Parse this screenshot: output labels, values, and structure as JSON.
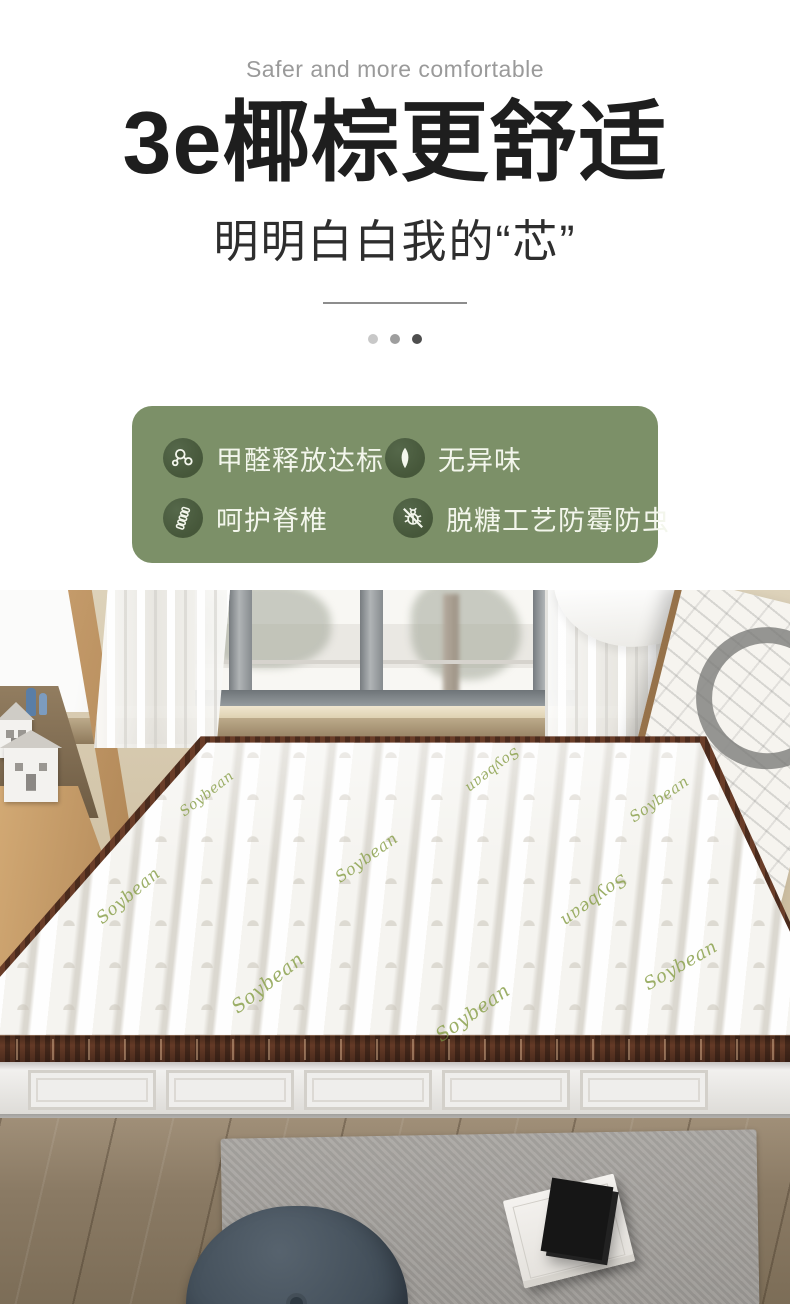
{
  "header": {
    "subtitle_en": "Safer and more comfortable",
    "title": "3e椰棕更舒适",
    "subtitle_cn": "明明白白我的“芯”"
  },
  "features": {
    "card_color": "#7c9068",
    "icon_circle_color": "#46573a",
    "label_color": "#f3f6ec",
    "items": [
      {
        "icon": "molecule-icon",
        "label": "甲醛释放达标"
      },
      {
        "icon": "leaf-icon",
        "label": "无异味"
      },
      {
        "icon": "spine-icon",
        "label": "呵护脊椎"
      },
      {
        "icon": "no-insect-icon",
        "label": "脱糖工艺防霉防虫"
      }
    ]
  },
  "photo": {
    "fabric_text": "Soybean"
  }
}
